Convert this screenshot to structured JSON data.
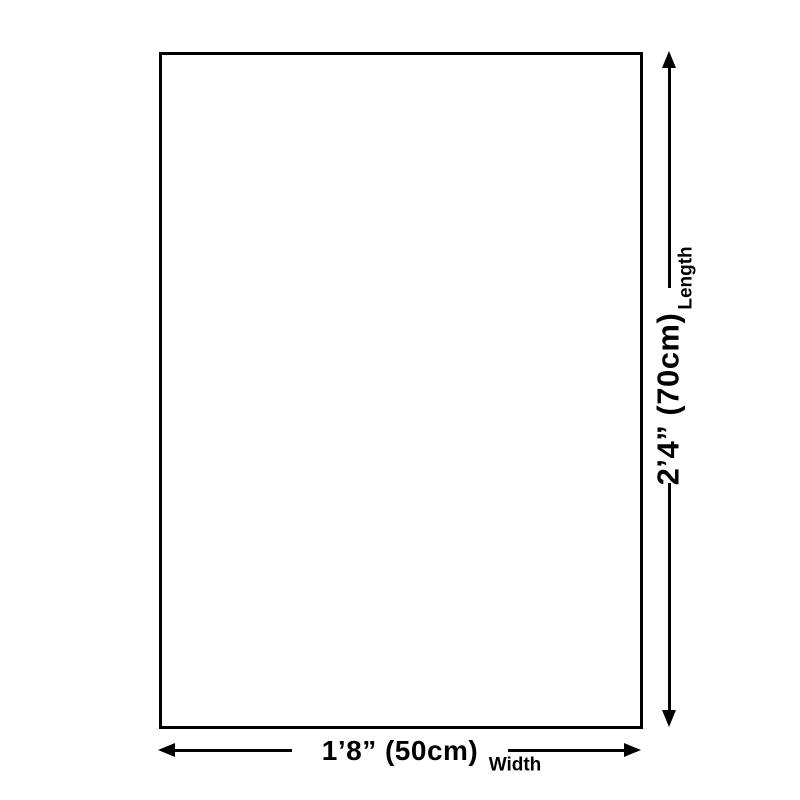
{
  "diagram": {
    "title": "product-size-diagram",
    "colors": {
      "background": "#ffffff",
      "line": "#000000",
      "text": "#000000"
    },
    "width_dimension": {
      "value": "1’8” (50cm)",
      "label": "Width"
    },
    "length_dimension": {
      "value": "2’4” (70cm)",
      "label": "Length"
    }
  }
}
